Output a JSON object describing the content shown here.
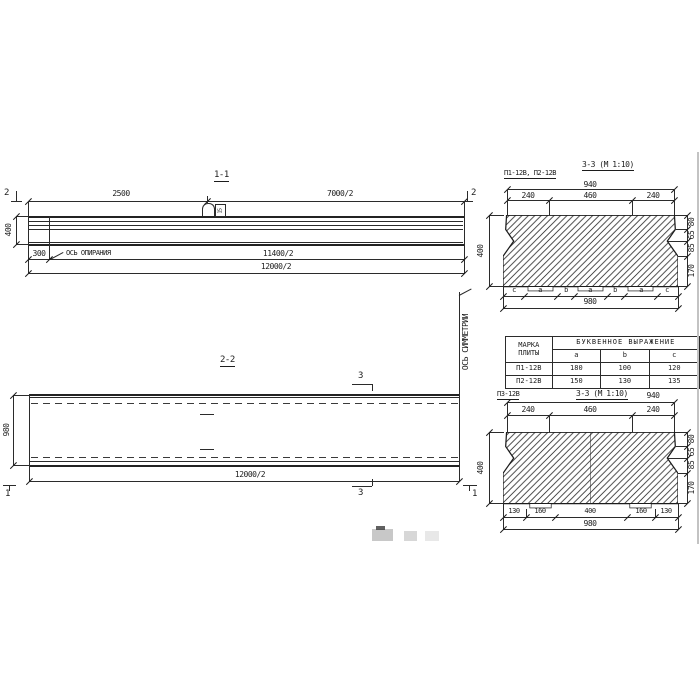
{
  "section_11": {
    "title": "1-1",
    "dim_top_left": "2500",
    "dim_top_right": "7000/2",
    "dim_height": "400",
    "dim_offset": "300",
    "bearing_axis_label": "ОСЬ ОПИРАНИЯ",
    "dim_span_inner": "11400/2",
    "dim_span_outer": "12000/2",
    "cut_mark": "2",
    "loop_tag": "15"
  },
  "section_22": {
    "title": "2-2",
    "dim_width": "980",
    "dim_length": "12000/2",
    "cut_mark_3": "3",
    "cut_mark_1": "1",
    "symmetry_axis_label": "ОСЬ СИММЕТРИИ"
  },
  "section_33_p12": {
    "plate_marks": "П1-12В, П2-12В",
    "title": "3-3 (М 1:10)",
    "dim_top_total": "940",
    "dims_top": [
      "240",
      "460",
      "240"
    ],
    "dim_height": "400",
    "dims_right": [
      "80",
      "65",
      "85",
      "170"
    ],
    "letter_row": [
      "c",
      "a",
      "b",
      "a",
      "b",
      "a",
      "c"
    ],
    "dim_bottom_total": "980"
  },
  "letter_table": {
    "header_mark": "МАРКА ПЛИТЫ",
    "header_expr": "БУКВЕННОЕ ВЫРАЖЕНИЕ",
    "columns": [
      "a",
      "b",
      "c"
    ],
    "rows": [
      {
        "mark": "П1-12В",
        "a": "180",
        "b": "100",
        "c": "120"
      },
      {
        "mark": "П2-12В",
        "a": "150",
        "b": "130",
        "c": "135"
      }
    ]
  },
  "section_33_p3": {
    "plate_marks": "П3-12В",
    "title": "3-3 (М 1:10)",
    "dim_top_total": "940",
    "dims_top": [
      "240",
      "460",
      "240"
    ],
    "dim_height": "400",
    "dims_right": [
      "80",
      "65",
      "85",
      "170"
    ],
    "dims_bottom": [
      "130",
      "160",
      "400",
      "160",
      "130"
    ],
    "dim_bottom_total": "980"
  }
}
